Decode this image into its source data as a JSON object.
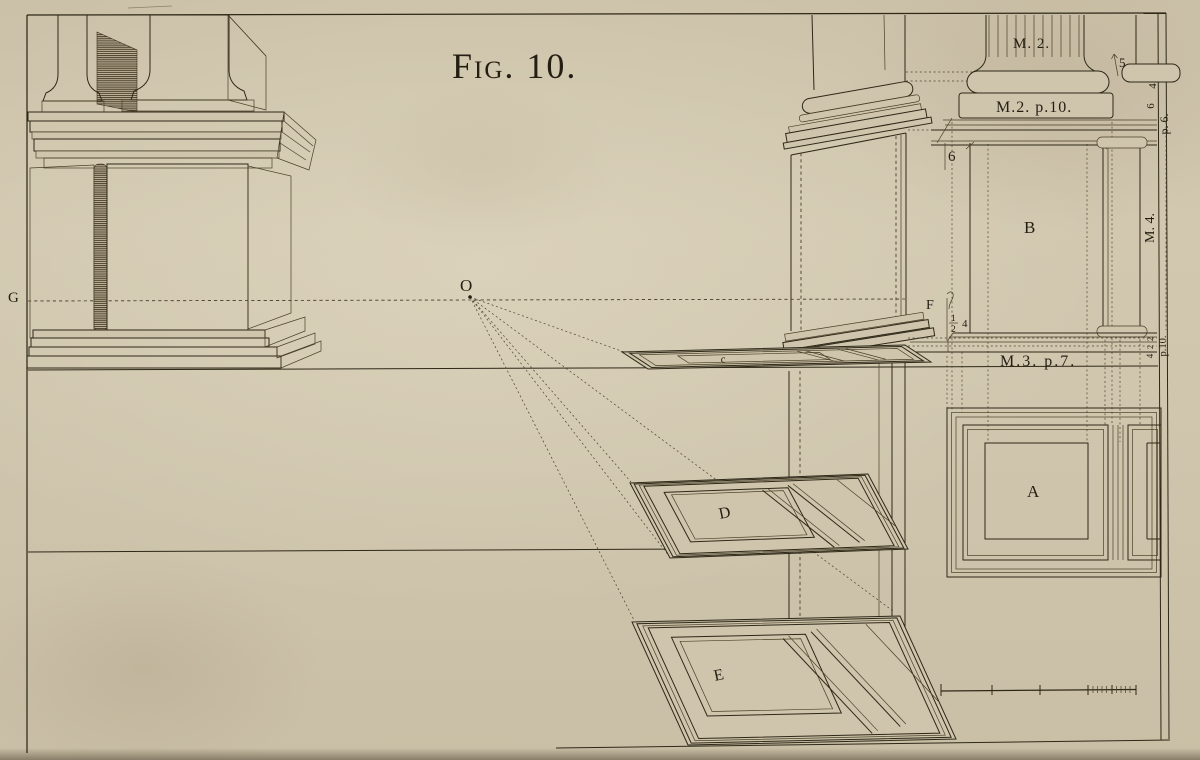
{
  "plate": {
    "title": "Fig. 10.",
    "colors": {
      "paper": "#cfc5ad",
      "ink": "#2a2417"
    },
    "labels": {
      "g": "G",
      "o": "O",
      "c": "c",
      "d": "D",
      "e": "E",
      "f": "F",
      "b": "B",
      "a": "A",
      "six_under_cornice": "6",
      "five": "5",
      "m2_column": "M. 2.",
      "m2_p10": "M.2. p.10.",
      "m3_p7": "M.3. p.7.",
      "m4_margin": "M. 4.",
      "p6_margin": "p. 6.",
      "p10_margin": "p.10.",
      "four_margin": "4",
      "six_margin": "6",
      "frac_numerator": "1",
      "frac_denominator": "2",
      "four_after_frac": "4",
      "stack_top": "2",
      "stack_middle": "2",
      "stack_bottom": "4"
    }
  }
}
